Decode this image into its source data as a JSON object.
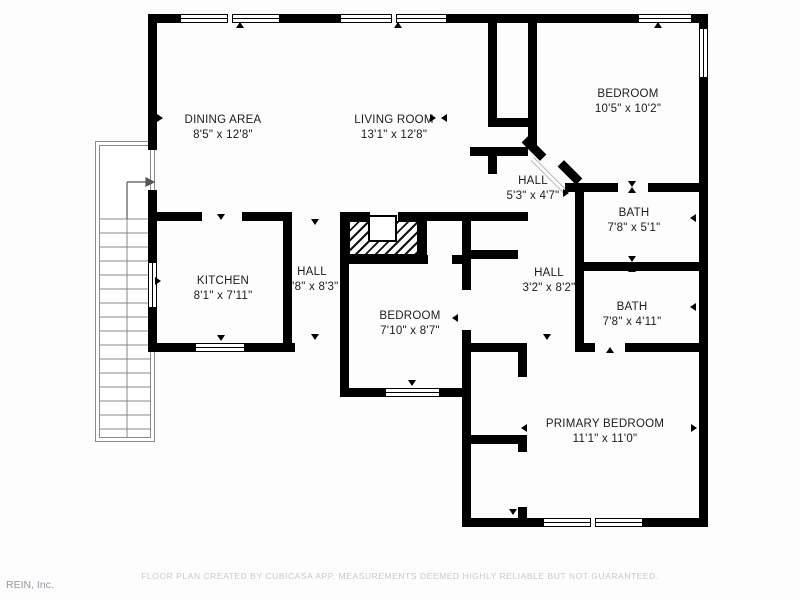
{
  "plan": {
    "rooms": [
      {
        "name": "DINING AREA",
        "dims": "8'5\" x 12'8\""
      },
      {
        "name": "LIVING ROOM",
        "dims": "13'1\" x 12'8\""
      },
      {
        "name": "BEDROOM",
        "dims": "10'5\" x 10'2\""
      },
      {
        "name": "HALL",
        "dims": "5'3\" x 4'7\""
      },
      {
        "name": "BATH",
        "dims": "7'8\" x 5'1\""
      },
      {
        "name": "KITCHEN",
        "dims": "8'1\" x 7'11\""
      },
      {
        "name": "HALL",
        "dims": "3'8\" x 8'3\""
      },
      {
        "name": "BEDROOM",
        "dims": "7'10\" x 8'7\""
      },
      {
        "name": "HALL",
        "dims": "3'2\" x 8'2\""
      },
      {
        "name": "BATH",
        "dims": "7'8\" x 4'11\""
      },
      {
        "name": "PRIMARY BEDROOM",
        "dims": "11'1\" x 11'0\""
      }
    ],
    "footer": "FLOOR PLAN CREATED BY CUBICASA APP. MEASUREMENTS DEEMED HIGHLY RELIABLE BUT NOT GUARANTEED.",
    "watermark": "REIN, Inc.",
    "colors": {
      "wall": "#000000",
      "label_text": "#1b1b1b",
      "footer_text": "#c9c9c9",
      "watermark_text": "#9199a3",
      "background": "#fdfdfd"
    }
  }
}
